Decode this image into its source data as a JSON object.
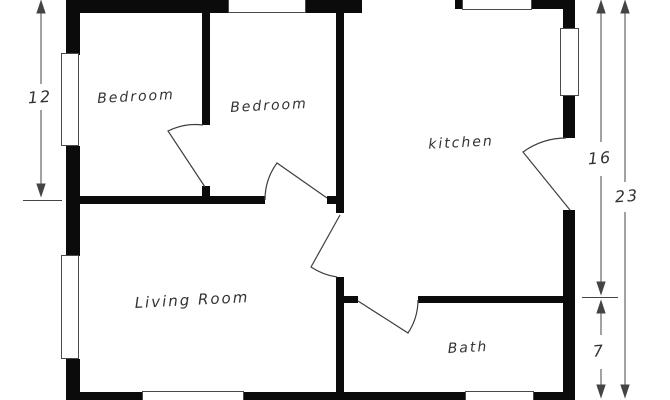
{
  "title": "House floor plan",
  "colors": {
    "wall": "#0b0b0b",
    "thin_line": "#3f3f3f",
    "window_border": "#4a4a4a",
    "background": "#ffffff",
    "text": "#333333"
  },
  "rooms": {
    "bedroom1": {
      "label": "Bedroom"
    },
    "bedroom2": {
      "label": "Bedroom"
    },
    "kitchen": {
      "label": "kitchen"
    },
    "living_room": {
      "label": "Living Room"
    },
    "bath": {
      "label": "Bath"
    }
  },
  "dimensions": {
    "left_bedroom_height": "12",
    "right_kitchen_height": "16",
    "right_total_height": "23",
    "right_bath_height": "7"
  }
}
